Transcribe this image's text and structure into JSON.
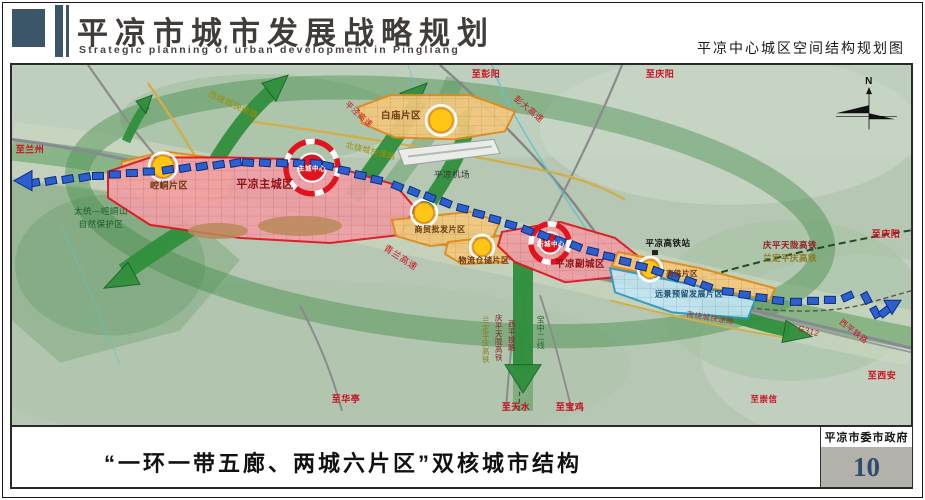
{
  "header": {
    "title_cn": "平凉市城市发展战略规划",
    "title_en": "Strategic planning of urban development in Pingliang",
    "sheet_title": "平凉中心城区空间结构规划图"
  },
  "footer": {
    "caption": "“一环一带五廊、两城六片区”双核城市结构",
    "publisher": "平凉市委市政府",
    "page_number": "10"
  },
  "colors": {
    "map_background": "#b6c8b4",
    "corridor_green": "#2f8f3c",
    "zone_red_fill": "#f0a0a6",
    "zone_red_border": "#e0131f",
    "zone_orange_fill": "#f3c87d",
    "zone_orange_border": "#e08a1a",
    "zone_blue_fill": "#c3e5f2",
    "node_yellow": "#ffc616",
    "transit_blue": "#2c5fd0",
    "page_number_blue": "#2d4d6f"
  },
  "map": {
    "compass": "N",
    "labels": [
      {
        "text": "至兰州",
        "x": 30,
        "y": 153,
        "size": 9,
        "color": "#cc1122",
        "bold": true
      },
      {
        "text": "至彭阳",
        "x": 486,
        "y": 78,
        "size": 9,
        "color": "#cc1122",
        "bold": true
      },
      {
        "text": "彭大高速",
        "x": 527,
        "y": 112,
        "size": 8.5,
        "color": "#cc1122",
        "rot": 40
      },
      {
        "text": "至庆阳",
        "x": 660,
        "y": 78,
        "size": 9,
        "color": "#cc1122",
        "bold": true
      },
      {
        "text": "平泾高速",
        "x": 357,
        "y": 117,
        "size": 8,
        "color": "#cc1122",
        "rot": 42
      },
      {
        "text": "西绕城快速路",
        "x": 232,
        "y": 108,
        "size": 8.5,
        "color": "#a08c00",
        "rot": 25
      },
      {
        "text": "北绕城快速路",
        "x": 370,
        "y": 154,
        "size": 8,
        "color": "#a08c00",
        "rot": 14
      },
      {
        "text": "白庙片区",
        "x": 401,
        "y": 119,
        "size": 9.5,
        "color": "#6b3a10",
        "bold": true
      },
      {
        "text": "崆峒片区",
        "x": 169,
        "y": 189,
        "size": 9,
        "color": "#6b3a10",
        "bold": true
      },
      {
        "text": "平凉主城区",
        "x": 265,
        "y": 188,
        "size": 11,
        "color": "#8f1016",
        "bold": true
      },
      {
        "text": "主城中心",
        "x": 312,
        "y": 171,
        "size": 6.5,
        "color": "#ffffff",
        "bold": true
      },
      {
        "text": "平凉机场",
        "x": 452,
        "y": 178,
        "size": 8.5,
        "color": "#333333"
      },
      {
        "text": "太统—崆峒山",
        "x": 101,
        "y": 214,
        "size": 8.5,
        "color": "#1d5c2e"
      },
      {
        "text": "自然保护区",
        "x": 101,
        "y": 227,
        "size": 8.5,
        "color": "#1d5c2e"
      },
      {
        "text": "商贸批发片区",
        "x": 440,
        "y": 232,
        "size": 8,
        "color": "#6b3a10",
        "bold": true
      },
      {
        "text": "青兰高速",
        "x": 399,
        "y": 260,
        "size": 9,
        "color": "#cc1122",
        "rot": 33
      },
      {
        "text": "物流仓储片区",
        "x": 484,
        "y": 263,
        "size": 8,
        "color": "#6b3a10",
        "bold": true
      },
      {
        "text": "新城中心",
        "x": 551,
        "y": 246,
        "size": 6.5,
        "color": "#ffffff",
        "bold": true
      },
      {
        "text": "平凉副城区",
        "x": 580,
        "y": 267,
        "size": 9.5,
        "color": "#8f1016",
        "bold": true
      },
      {
        "text": "平凉高铁站",
        "x": 668,
        "y": 246,
        "size": 8.5,
        "color": "#111111",
        "bold": true
      },
      {
        "text": "高铁片区",
        "x": 682,
        "y": 276,
        "size": 7.5,
        "color": "#6b3a10",
        "bold": true
      },
      {
        "text": "远景预留发展片区",
        "x": 689,
        "y": 296,
        "size": 8,
        "color": "#1c4f74",
        "bold": true
      },
      {
        "text": "南绕城快速路",
        "x": 710,
        "y": 320,
        "size": 7.5,
        "color": "#a23333",
        "rot": 9
      },
      {
        "text": "庆平天陇高铁",
        "x": 790,
        "y": 248,
        "size": 8.5,
        "color": "#8f1d22",
        "bold": true
      },
      {
        "text": "兰定平庆高铁",
        "x": 790,
        "y": 261,
        "size": 8.5,
        "color": "#8a7a1e",
        "bold": true
      },
      {
        "text": "至庆阳",
        "x": 886,
        "y": 237,
        "size": 9,
        "color": "#cc1122",
        "bold": true
      },
      {
        "text": "G312",
        "x": 808,
        "y": 333,
        "size": 8,
        "color": "#cc1122",
        "rot": 16
      },
      {
        "text": "西平铁路",
        "x": 852,
        "y": 333,
        "size": 8,
        "color": "#cc1122",
        "rot": 38
      },
      {
        "text": "至西安",
        "x": 882,
        "y": 378,
        "size": 9,
        "color": "#cc1122",
        "bold": true
      },
      {
        "text": "至崇信",
        "x": 764,
        "y": 401,
        "size": 8.5,
        "color": "#cc1122",
        "bold": true
      },
      {
        "text": "至华亭",
        "x": 346,
        "y": 401,
        "size": 9,
        "color": "#cc1122",
        "bold": true
      },
      {
        "text": "至天水",
        "x": 516,
        "y": 409,
        "size": 9,
        "color": "#cc1122",
        "bold": true
      },
      {
        "text": "至宝鸡",
        "x": 570,
        "y": 409,
        "size": 9,
        "color": "#cc1122",
        "bold": true
      },
      {
        "text": "兰定平庆高铁",
        "x": 486,
        "y": 322,
        "size": 7.5,
        "color": "#8a7a1e",
        "vertical": true
      },
      {
        "text": "庆平天陇高铁",
        "x": 499,
        "y": 320,
        "size": 7.5,
        "color": "#8f1d22",
        "vertical": true
      },
      {
        "text": "西平铁路",
        "x": 512,
        "y": 326,
        "size": 7.5,
        "color": "#8f1d22",
        "vertical": true
      },
      {
        "text": "宝中二线",
        "x": 541,
        "y": 322,
        "size": 8,
        "color": "#1d6a2e",
        "vertical": true
      },
      {
        "text": "N",
        "x": 869,
        "y": 85,
        "size": 10,
        "color": "#111111",
        "bold": true
      }
    ]
  }
}
